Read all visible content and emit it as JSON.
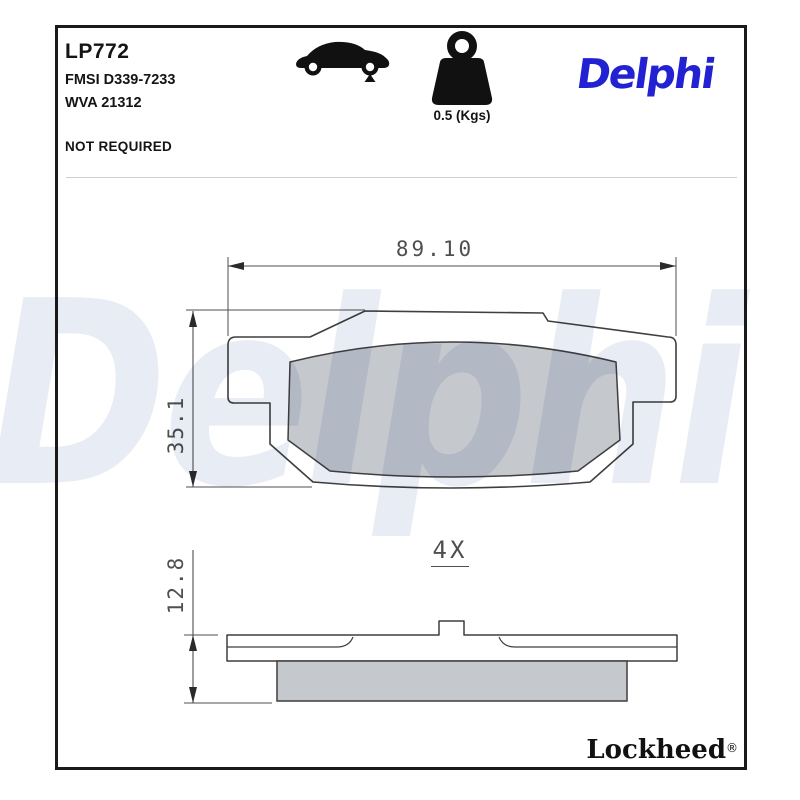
{
  "header": {
    "part_code": "LP772",
    "fmsi_ref": "FMSI D339-7233",
    "wva_ref": "WVA 21312",
    "fitting_note": "NOT REQUIRED",
    "weight_label": "0.5 (Kgs)",
    "brand_logo": "Delphi"
  },
  "icons": {
    "car_icon": "car-side-silhouette-rear-axle-marker",
    "weight_icon": "kettlebell-weight"
  },
  "drawing": {
    "width_dim": "89.10",
    "height_dim": "35.1",
    "thickness_dim": "12.8",
    "quantity_label": "4X"
  },
  "watermark_text": "Delphi",
  "footer": {
    "manufacturer": "Lockheed",
    "registered_mark": "®"
  },
  "colors": {
    "brand_blue": "#2222d2",
    "watermark_blue": "#e8ecf4",
    "friction_gray": "#c5c8cd",
    "outline_dark": "#3f3f3f",
    "dimension_gray": "#4f4f4f",
    "frame_black": "#1a1a1a"
  }
}
